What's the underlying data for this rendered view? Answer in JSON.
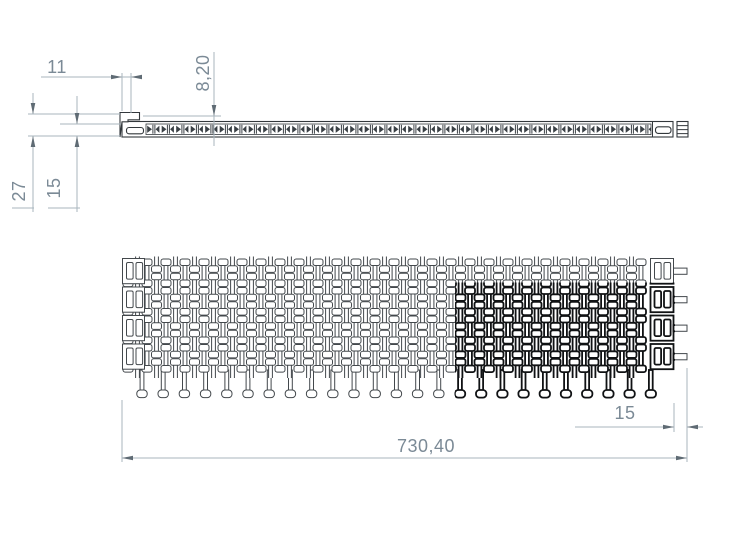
{
  "dimensions": {
    "hook_width": "11",
    "thickness": "8,20",
    "total_height": "27",
    "inner_height": "15",
    "pin_protrusion": "15",
    "overall_width": "730,40"
  },
  "colors": {
    "edge": "#43484c",
    "edge2": "#33383c",
    "bold": "#101214",
    "dim_line": "#a9b6be",
    "dim_arrow": "#5f6b74",
    "dim_text": "#7b8a96",
    "bg": "#ffffff"
  }
}
